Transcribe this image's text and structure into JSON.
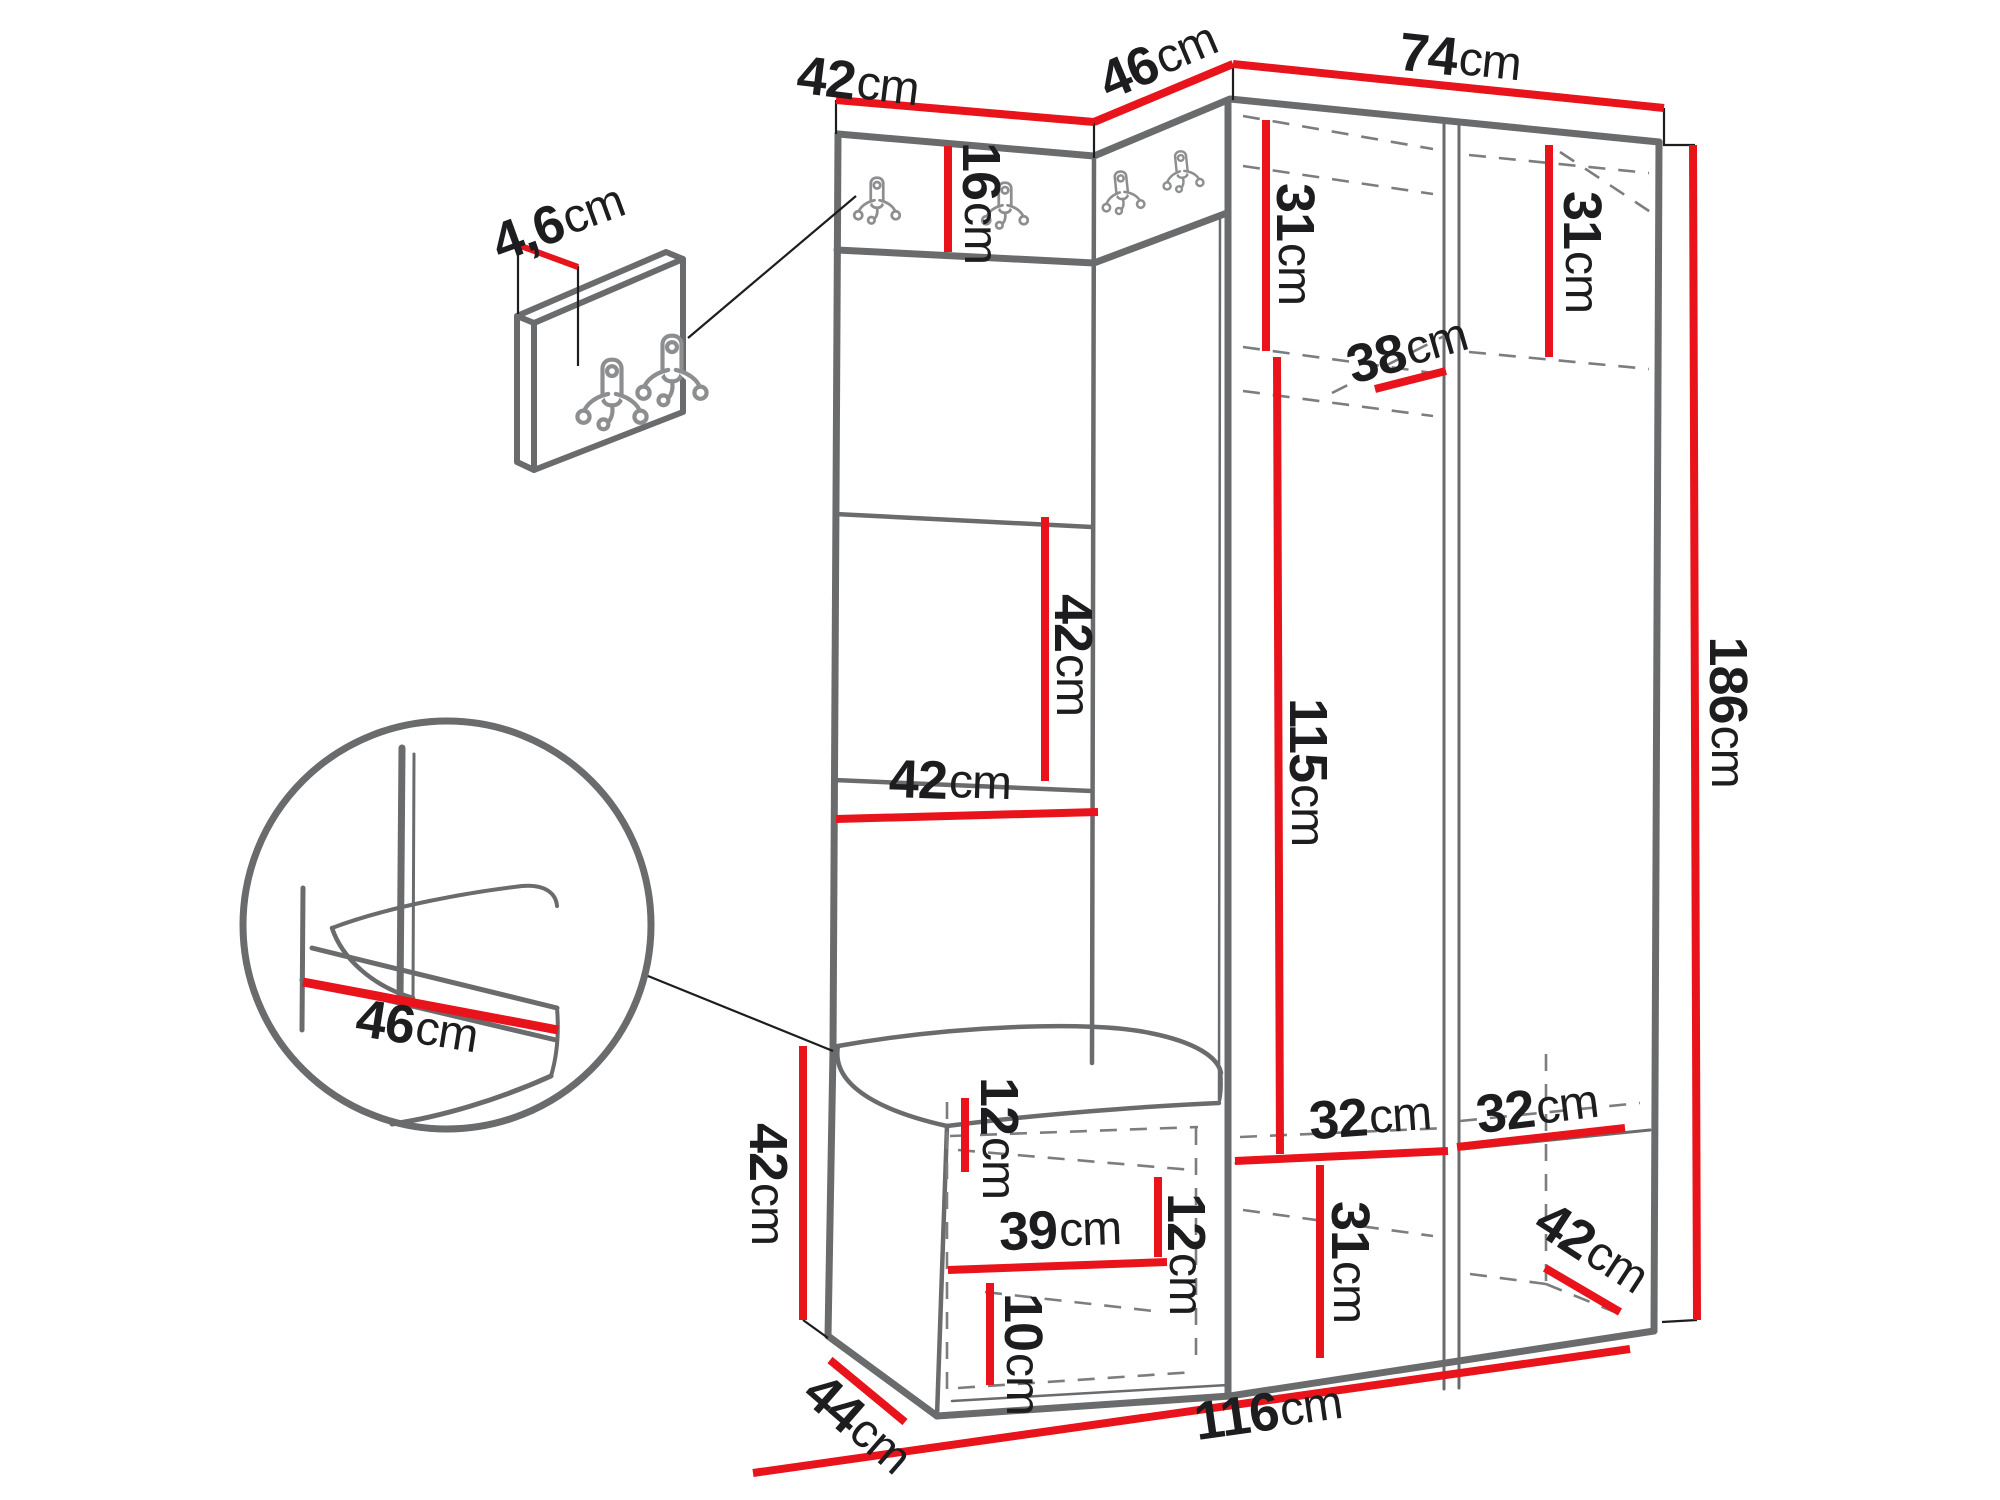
{
  "title": "Hallway furniture set dimension diagram",
  "unit_default": "cm",
  "colors": {
    "dimension_line": "#e8131b",
    "furniture_outline": "#6a6b6d",
    "hidden_line": "#7c7d7f",
    "label_text": "#1d1d1f",
    "background": "#ffffff"
  },
  "icons": {
    "coat_hook": {
      "name": "double-coat-hook-icon",
      "wall_panel_count": 2,
      "hook_rail_count": 4
    }
  },
  "annotations": [
    {
      "id": "top-panel-width",
      "value": "42",
      "unit": "cm",
      "x": 858,
      "y": 82,
      "rot": 7
    },
    {
      "id": "top-corner-width",
      "value": "46",
      "unit": "cm",
      "x": 1158,
      "y": 60,
      "rot": -23
    },
    {
      "id": "top-wardrobe-width",
      "value": "74",
      "unit": "cm",
      "x": 1460,
      "y": 58,
      "rot": 6
    },
    {
      "id": "wall-panel-thickness",
      "value": "4,6",
      "unit": "cm",
      "x": 558,
      "y": 222,
      "rot": -20
    },
    {
      "id": "hook-rail-height",
      "value": "16",
      "unit": "cm",
      "x": 981,
      "y": 203,
      "rot": 90
    },
    {
      "id": "wardrobe-left-top",
      "value": "31",
      "unit": "cm",
      "x": 1295,
      "y": 244,
      "rot": 90
    },
    {
      "id": "wardrobe-right-top",
      "value": "31",
      "unit": "cm",
      "x": 1582,
      "y": 252,
      "rot": 90
    },
    {
      "id": "shelf-depth",
      "value": "38",
      "unit": "cm",
      "x": 1407,
      "y": 350,
      "rot": -16
    },
    {
      "id": "panel-section-height",
      "value": "42",
      "unit": "cm",
      "x": 1073,
      "y": 655,
      "rot": 90
    },
    {
      "id": "panel-section-width",
      "value": "42",
      "unit": "cm",
      "x": 950,
      "y": 781,
      "rot": 2
    },
    {
      "id": "hanging-space-height",
      "value": "115",
      "unit": "cm",
      "x": 1308,
      "y": 772,
      "rot": 90
    },
    {
      "id": "total-height",
      "value": "186",
      "unit": "cm",
      "x": 1728,
      "y": 712,
      "rot": 90
    },
    {
      "id": "seat-depth-detail",
      "value": "46",
      "unit": "cm",
      "x": 417,
      "y": 1027,
      "rot": 9
    },
    {
      "id": "bench-height",
      "value": "42",
      "unit": "cm",
      "x": 768,
      "y": 1184,
      "rot": 90
    },
    {
      "id": "seat-frame-height",
      "value": "12",
      "unit": "cm",
      "x": 999,
      "y": 1138,
      "rot": 90
    },
    {
      "id": "bench-inner-width",
      "value": "39",
      "unit": "cm",
      "x": 1060,
      "y": 1230,
      "rot": -2
    },
    {
      "id": "bench-inner-height",
      "value": "12",
      "unit": "cm",
      "x": 1186,
      "y": 1254,
      "rot": 90
    },
    {
      "id": "bench-base-height",
      "value": "10",
      "unit": "cm",
      "x": 1023,
      "y": 1354,
      "rot": 90
    },
    {
      "id": "bottom-shelf-left",
      "value": "32",
      "unit": "cm",
      "x": 1370,
      "y": 1117,
      "rot": -4
    },
    {
      "id": "bottom-shelf-right",
      "value": "32",
      "unit": "cm",
      "x": 1537,
      "y": 1108,
      "rot": -7
    },
    {
      "id": "bottom-section-height",
      "value": "31",
      "unit": "cm",
      "x": 1350,
      "y": 1262,
      "rot": 90
    },
    {
      "id": "bottom-depth",
      "value": "42",
      "unit": "cm",
      "x": 1592,
      "y": 1248,
      "rot": 33
    },
    {
      "id": "bench-depth",
      "value": "44",
      "unit": "cm",
      "x": 858,
      "y": 1424,
      "rot": 41
    },
    {
      "id": "total-width",
      "value": "116",
      "unit": "cm",
      "x": 1268,
      "y": 1412,
      "rot": -8
    }
  ]
}
